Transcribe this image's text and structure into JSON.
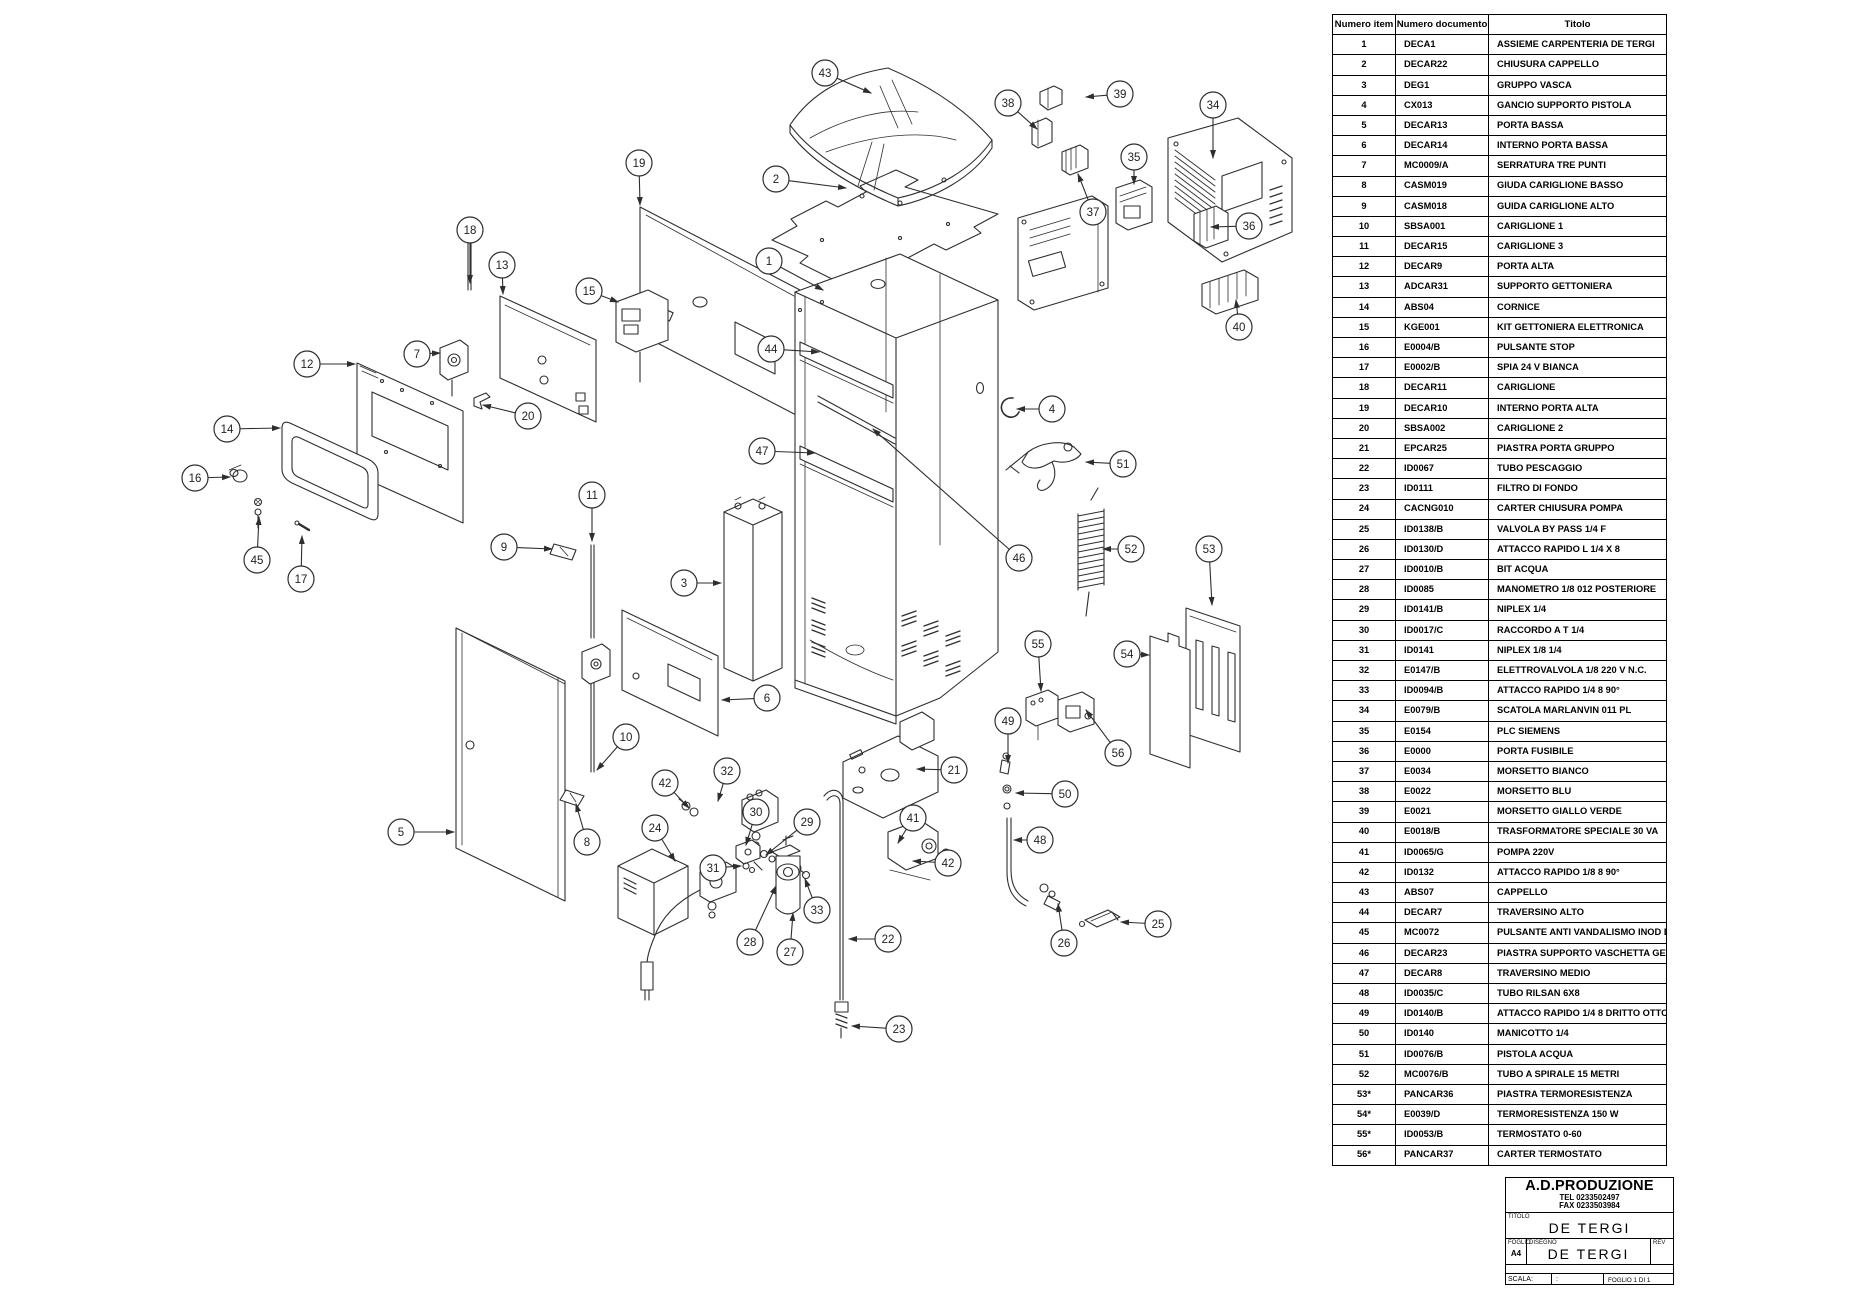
{
  "table": {
    "headers": [
      "Numero item",
      "Numero documento",
      "Titolo"
    ],
    "rows": [
      [
        "1",
        "DECA1",
        "ASSIEME CARPENTERIA DE TERGI"
      ],
      [
        "2",
        "DECAR22",
        "CHIUSURA CAPPELLO"
      ],
      [
        "3",
        "DEG1",
        "GRUPPO VASCA"
      ],
      [
        "4",
        "CX013",
        "GANCIO SUPPORTO PISTOLA"
      ],
      [
        "5",
        "DECAR13",
        "PORTA BASSA"
      ],
      [
        "6",
        "DECAR14",
        "INTERNO PORTA BASSA"
      ],
      [
        "7",
        "MC0009/A",
        "SERRATURA TRE PUNTI"
      ],
      [
        "8",
        "CASM019",
        "GIUDA CARIGLIONE BASSO"
      ],
      [
        "9",
        "CASM018",
        "GUIDA CARIGLIONE ALTO"
      ],
      [
        "10",
        "SBSA001",
        "CARIGLIONE 1"
      ],
      [
        "11",
        "DECAR15",
        "CARIGLIONE 3"
      ],
      [
        "12",
        "DECAR9",
        "PORTA ALTA"
      ],
      [
        "13",
        "ADCAR31",
        "SUPPORTO GETTONIERA"
      ],
      [
        "14",
        "ABS04",
        "CORNICE"
      ],
      [
        "15",
        "KGE001",
        "KIT GETTONIERA ELETTRONICA"
      ],
      [
        "16",
        "E0004/B",
        "PULSANTE STOP"
      ],
      [
        "17",
        "E0002/B",
        "SPIA 24 V BIANCA"
      ],
      [
        "18",
        "DECAR11",
        "CARIGLIONE"
      ],
      [
        "19",
        "DECAR10",
        "INTERNO PORTA ALTA"
      ],
      [
        "20",
        "SBSA002",
        "CARIGLIONE 2"
      ],
      [
        "21",
        "EPCAR25",
        "PIASTRA PORTA GRUPPO"
      ],
      [
        "22",
        "ID0067",
        "TUBO PESCAGGIO"
      ],
      [
        "23",
        "ID0111",
        "FILTRO DI FONDO"
      ],
      [
        "24",
        "CACNG010",
        "CARTER CHIUSURA POMPA"
      ],
      [
        "25",
        "ID0138/B",
        "VALVOLA BY PASS 1/4 F"
      ],
      [
        "26",
        "ID0130/D",
        "ATTACCO RAPIDO L 1/4 X 8"
      ],
      [
        "27",
        "ID0010/B",
        "BIT ACQUA"
      ],
      [
        "28",
        "ID0085",
        "MANOMETRO 1/8 012 POSTERIORE"
      ],
      [
        "29",
        "ID0141/B",
        "NIPLEX 1/4"
      ],
      [
        "30",
        "ID0017/C",
        "RACCORDO A T 1/4"
      ],
      [
        "31",
        "ID0141",
        "NIPLEX 1/8 1/4"
      ],
      [
        "32",
        "E0147/B",
        "ELETTROVALVOLA 1/8 220 V N.C."
      ],
      [
        "33",
        "ID0094/B",
        "ATTACCO RAPIDO 1/4 8 90°"
      ],
      [
        "34",
        "E0079/B",
        "SCATOLA MARLANVIN 011 PL"
      ],
      [
        "35",
        "E0154",
        "PLC SIEMENS"
      ],
      [
        "36",
        "E0000",
        "PORTA FUSIBILE"
      ],
      [
        "37",
        "E0034",
        "MORSETTO BIANCO"
      ],
      [
        "38",
        "E0022",
        "MORSETTO BLU"
      ],
      [
        "39",
        "E0021",
        "MORSETTO GIALLO VERDE"
      ],
      [
        "40",
        "E0018/B",
        "TRASFORMATORE SPECIALE 30 VA"
      ],
      [
        "41",
        "ID0065/G",
        "POMPA 220V"
      ],
      [
        "42",
        "ID0132",
        "ATTACCO RAPIDO 1/8 8 90°"
      ],
      [
        "43",
        "ABS07",
        "CAPPELLO"
      ],
      [
        "44",
        "DECAR7",
        "TRAVERSINO ALTO"
      ],
      [
        "45",
        "MC0072",
        "PULSANTE ANTI VANDALISMO INOD D 19"
      ],
      [
        "46",
        "DECAR23",
        "PIASTRA SUPPORTO VASCHETTA GETTONI"
      ],
      [
        "47",
        "DECAR8",
        "TRAVERSINO MEDIO"
      ],
      [
        "48",
        "ID0035/C",
        "TUBO RILSAN 6X8"
      ],
      [
        "49",
        "ID0140/B",
        "ATTACCO RAPIDO 1/4 8  DRITTO OTTONE"
      ],
      [
        "50",
        "ID0140",
        "MANICOTTO 1/4"
      ],
      [
        "51",
        "ID0076/B",
        "PISTOLA ACQUA"
      ],
      [
        "52",
        "MC0076/B",
        "TUBO A SPIRALE 15 METRI"
      ],
      [
        "53*",
        "PANCAR36",
        "PIASTRA TERMORESISTENZA"
      ],
      [
        "54*",
        "E0039/D",
        "TERMORESISTENZA 150 W"
      ],
      [
        "55*",
        "ID0053/B",
        "TERMOSTATO 0-60"
      ],
      [
        "56*",
        "PANCAR37",
        "CARTER TERMOSTATO"
      ]
    ]
  },
  "title_block": {
    "company": "A.D.PRODUZIONE",
    "tel": "TEL 0233502497",
    "fax": "FAX 0233503984",
    "titolo_label": "TITOLO",
    "titolo": "DE TERGI",
    "foglio_label": "FOGLIO",
    "foglio": "A4",
    "disegno_label": "DISEGNO",
    "disegno": "DE TERGI",
    "rev_label": "REV",
    "scala_label": "SCALA:",
    "scala_value": ":",
    "sheet": "FOGLIO 1 DI 1"
  },
  "diagram": {
    "line_color": "#2e2e2e",
    "balloons": [
      {
        "n": "1",
        "x": 769,
        "y": 261,
        "tx": 823,
        "ty": 290
      },
      {
        "n": "2",
        "x": 776,
        "y": 179,
        "tx": 846,
        "ty": 188
      },
      {
        "n": "3",
        "x": 684,
        "y": 583,
        "tx": 721,
        "ty": 583
      },
      {
        "n": "4",
        "x": 1052,
        "y": 409,
        "tx": 1017,
        "ty": 409
      },
      {
        "n": "5",
        "x": 401,
        "y": 832,
        "tx": 454,
        "ty": 832
      },
      {
        "n": "6",
        "x": 767,
        "y": 698,
        "tx": 722,
        "ty": 700
      },
      {
        "n": "7",
        "x": 417,
        "y": 354,
        "tx": 440,
        "ty": 353
      },
      {
        "n": "8",
        "x": 587,
        "y": 842,
        "tx": 576,
        "ty": 804
      },
      {
        "n": "9",
        "x": 504,
        "y": 547,
        "tx": 552,
        "ty": 549
      },
      {
        "n": "10",
        "x": 626,
        "y": 737,
        "tx": 597,
        "ty": 770
      },
      {
        "n": "11",
        "x": 592,
        "y": 495,
        "tx": 592,
        "ty": 541
      },
      {
        "n": "12",
        "x": 307,
        "y": 364,
        "tx": 355,
        "ty": 364
      },
      {
        "n": "13",
        "x": 502,
        "y": 265,
        "tx": 503,
        "ty": 294
      },
      {
        "n": "14",
        "x": 227,
        "y": 429,
        "tx": 280,
        "ty": 428
      },
      {
        "n": "15",
        "x": 589,
        "y": 291,
        "tx": 618,
        "ty": 302
      },
      {
        "n": "16",
        "x": 195,
        "y": 478,
        "tx": 230,
        "ty": 477
      },
      {
        "n": "17",
        "x": 301,
        "y": 579,
        "tx": 302,
        "ty": 536
      },
      {
        "n": "18",
        "x": 470,
        "y": 230,
        "tx": 470,
        "ty": 283
      },
      {
        "n": "19",
        "x": 639,
        "y": 163,
        "tx": 640,
        "ty": 205
      },
      {
        "n": "20",
        "x": 528,
        "y": 416,
        "tx": 483,
        "ty": 405
      },
      {
        "n": "21",
        "x": 954,
        "y": 770,
        "tx": 917,
        "ty": 769
      },
      {
        "n": "22",
        "x": 888,
        "y": 939,
        "tx": 849,
        "ty": 939
      },
      {
        "n": "23",
        "x": 899,
        "y": 1029,
        "tx": 852,
        "ty": 1026
      },
      {
        "n": "24",
        "x": 655,
        "y": 828,
        "tx": 675,
        "ty": 861
      },
      {
        "n": "25",
        "x": 1158,
        "y": 924,
        "tx": 1121,
        "ty": 922
      },
      {
        "n": "26",
        "x": 1064,
        "y": 943,
        "tx": 1058,
        "ty": 904
      },
      {
        "n": "27",
        "x": 790,
        "y": 952,
        "tx": 793,
        "ty": 913
      },
      {
        "n": "28",
        "x": 750,
        "y": 942,
        "tx": 776,
        "ty": 886
      },
      {
        "n": "29",
        "x": 807,
        "y": 822,
        "tx": 766,
        "ty": 855
      },
      {
        "n": "30",
        "x": 756,
        "y": 812,
        "tx": 746,
        "ty": 845
      },
      {
        "n": "31",
        "x": 713,
        "y": 868,
        "tx": 741,
        "ty": 866
      },
      {
        "n": "32",
        "x": 727,
        "y": 771,
        "tx": 718,
        "ty": 801
      },
      {
        "n": "33",
        "x": 817,
        "y": 910,
        "tx": 805,
        "ty": 879
      },
      {
        "n": "34",
        "x": 1213,
        "y": 105,
        "tx": 1213,
        "ty": 158
      },
      {
        "n": "35",
        "x": 1134,
        "y": 157,
        "tx": 1134,
        "ty": 184
      },
      {
        "n": "36",
        "x": 1249,
        "y": 226,
        "tx": 1211,
        "ty": 227
      },
      {
        "n": "37",
        "x": 1093,
        "y": 212,
        "tx": 1078,
        "ty": 174
      },
      {
        "n": "38",
        "x": 1008,
        "y": 103,
        "tx": 1037,
        "ty": 129
      },
      {
        "n": "39",
        "x": 1120,
        "y": 94,
        "tx": 1086,
        "ty": 97
      },
      {
        "n": "40",
        "x": 1239,
        "y": 327,
        "tx": 1236,
        "ty": 300
      },
      {
        "n": "41",
        "x": 913,
        "y": 818,
        "tx": 898,
        "ty": 843
      },
      {
        "n": "42",
        "x": 665,
        "y": 783,
        "tx": 689,
        "ty": 808
      },
      {
        "n": "42",
        "x": 948,
        "y": 863,
        "tx": 913,
        "ty": 861
      },
      {
        "n": "43",
        "x": 825,
        "y": 73,
        "tx": 871,
        "ty": 93
      },
      {
        "n": "44",
        "x": 771,
        "y": 349,
        "tx": 819,
        "ty": 352
      },
      {
        "n": "45",
        "x": 257,
        "y": 560,
        "tx": 259,
        "ty": 517
      },
      {
        "n": "46",
        "x": 1019,
        "y": 558,
        "tx": 873,
        "ty": 429
      },
      {
        "n": "47",
        "x": 762,
        "y": 451,
        "tx": 815,
        "ty": 453
      },
      {
        "n": "48",
        "x": 1040,
        "y": 840,
        "tx": 1014,
        "ty": 840
      },
      {
        "n": "49",
        "x": 1008,
        "y": 721,
        "tx": 1008,
        "ty": 763
      },
      {
        "n": "50",
        "x": 1065,
        "y": 794,
        "tx": 1016,
        "ty": 793
      },
      {
        "n": "51",
        "x": 1123,
        "y": 464,
        "tx": 1086,
        "ty": 462
      },
      {
        "n": "52",
        "x": 1131,
        "y": 549,
        "tx": 1103,
        "ty": 549
      },
      {
        "n": "53",
        "x": 1209,
        "y": 549,
        "tx": 1212,
        "ty": 605
      },
      {
        "n": "54",
        "x": 1127,
        "y": 654,
        "tx": 1149,
        "ty": 655
      },
      {
        "n": "55",
        "x": 1038,
        "y": 644,
        "tx": 1041,
        "ty": 691
      },
      {
        "n": "56",
        "x": 1118,
        "y": 753,
        "tx": 1086,
        "ty": 710
      }
    ]
  }
}
